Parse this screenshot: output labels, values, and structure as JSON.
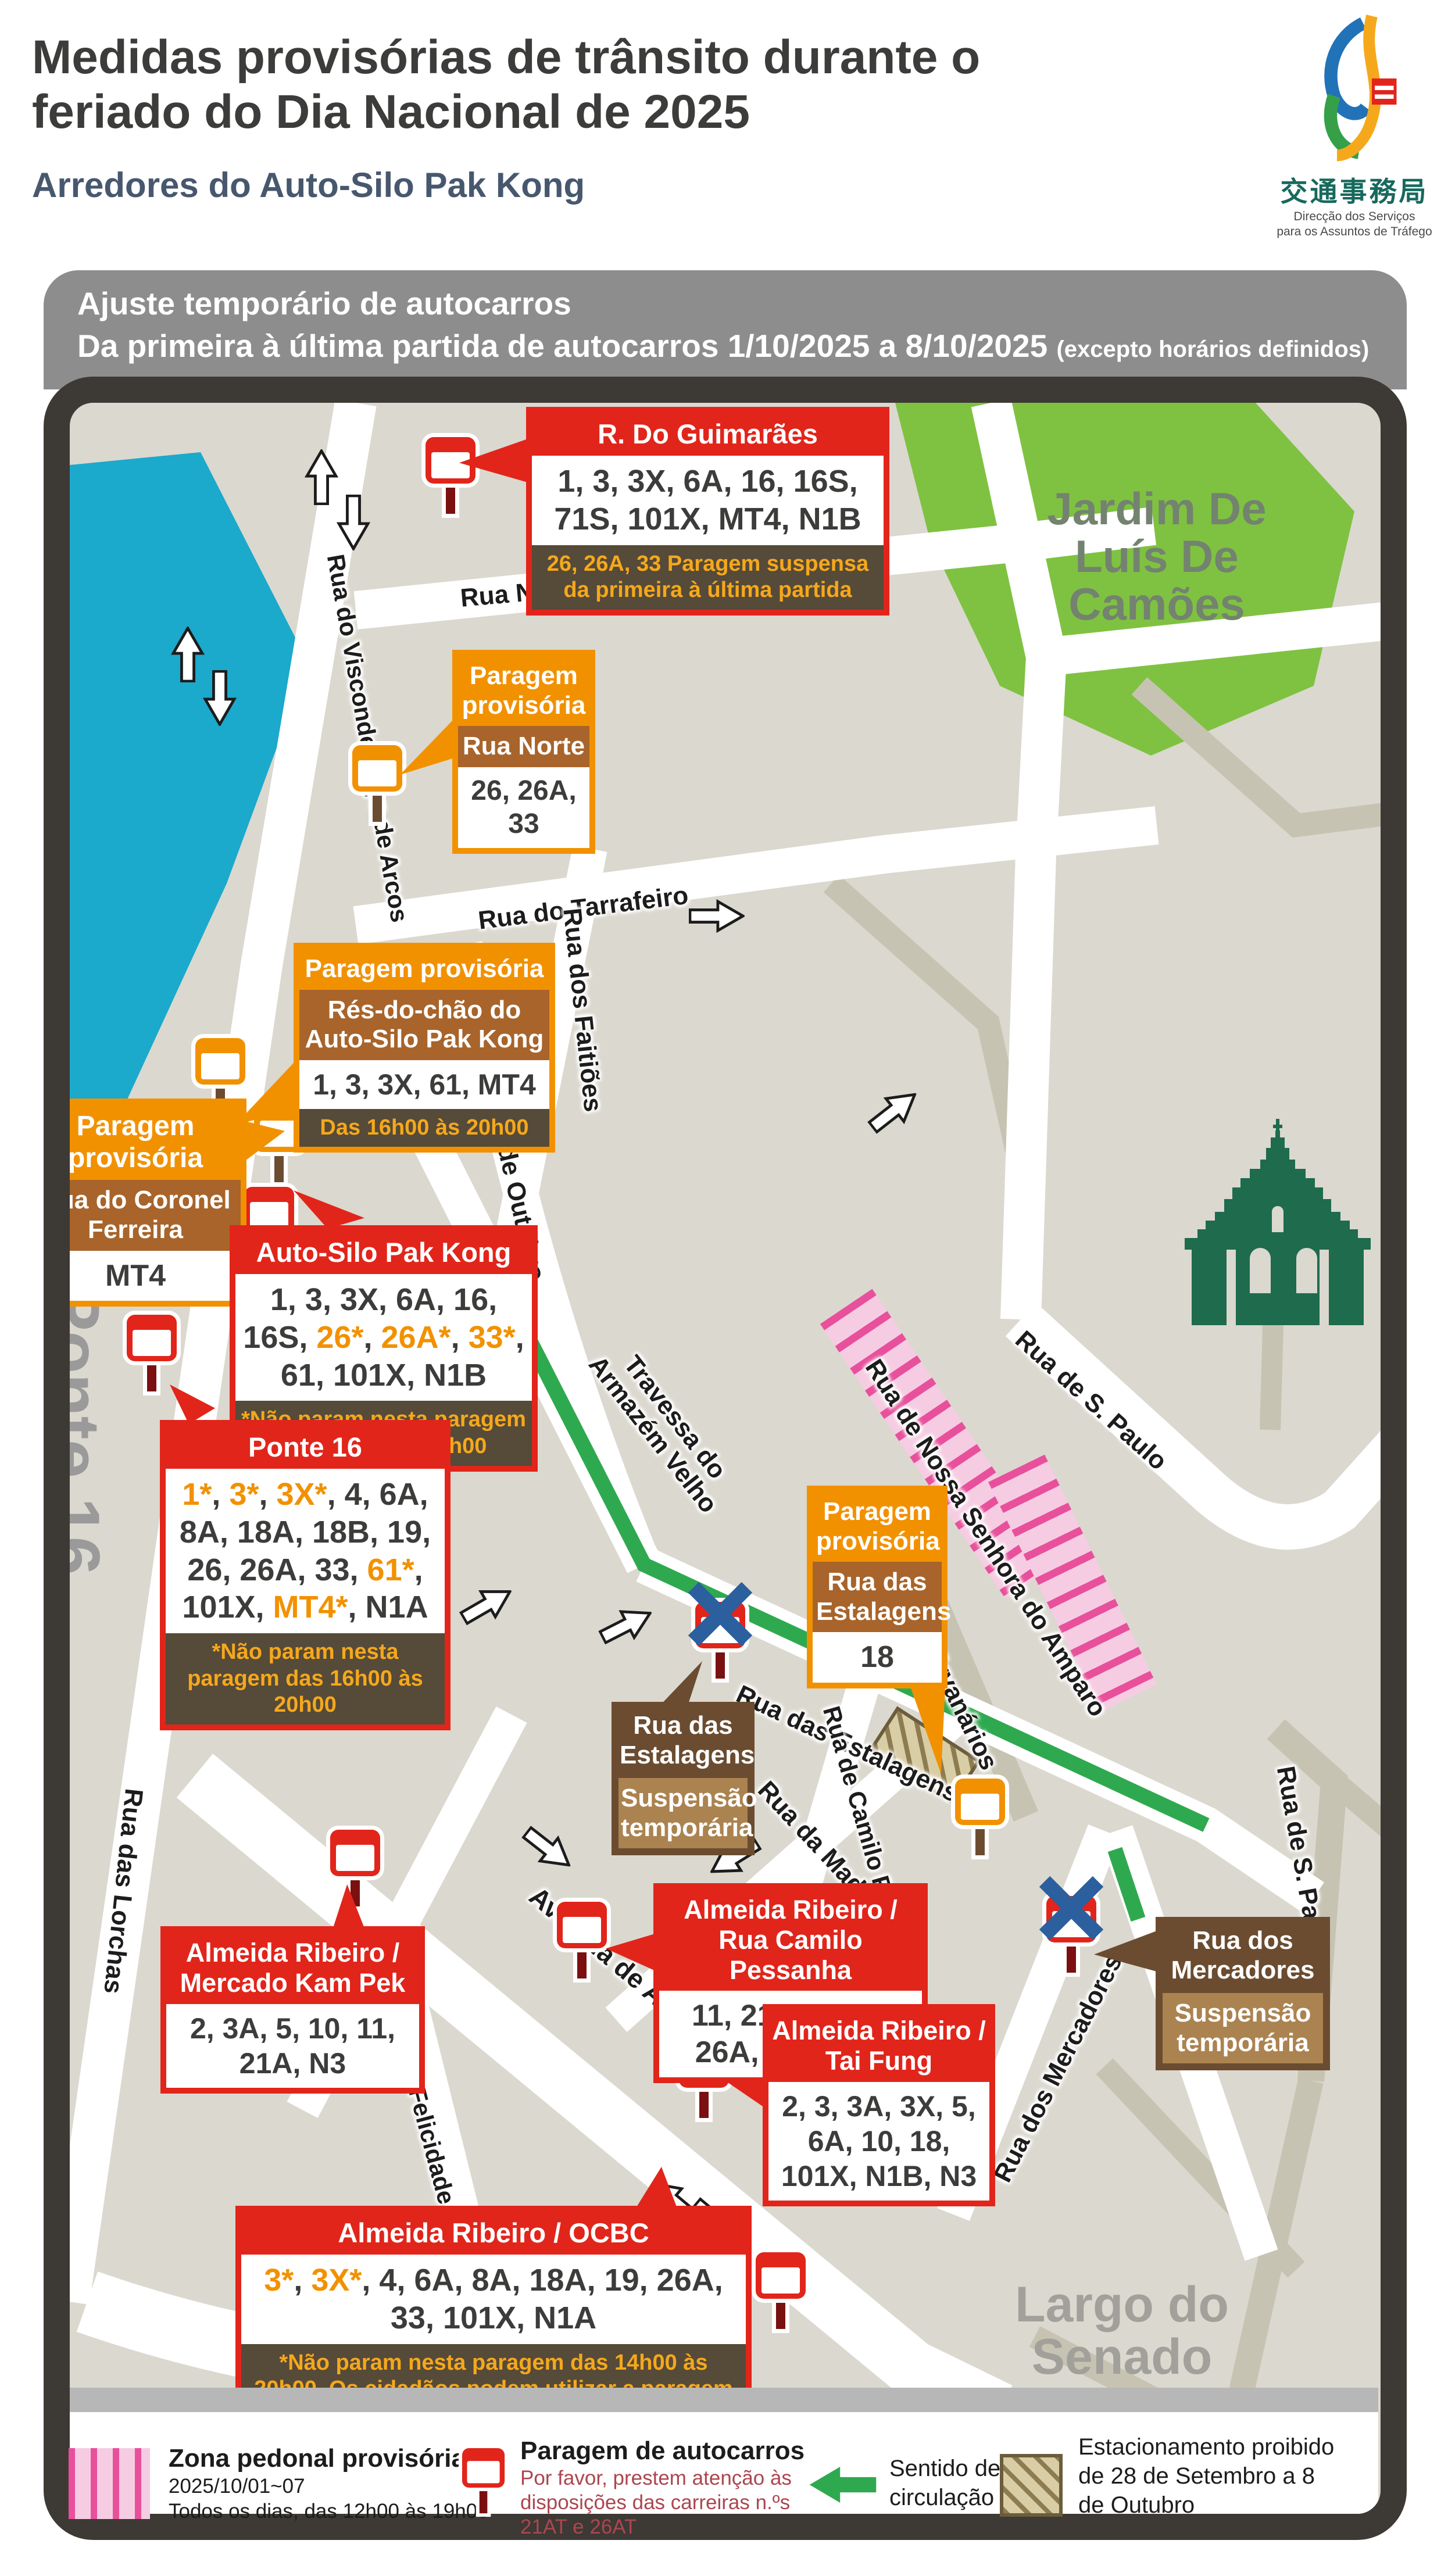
{
  "colors": {
    "orange": "#f29100",
    "blue": "#1b7ac0",
    "dark": "#3c3c3b"
  },
  "header": {
    "title1": "Medidas provisórias de trânsito durante o",
    "title2": "feriado do Dia Nacional de 2025",
    "subtitle": "Arredores do Auto-Silo Pak Kong",
    "logo_cn": "交通事務局",
    "logo_pt1": "Direcção dos Serviços",
    "logo_pt2": "para os Assuntos de Tráfego"
  },
  "banner": {
    "line1": "Ajuste temporário de autocarros",
    "line2": "Da primeira à última partida de autocarros 1/10/2025 a 8/10/2025 ",
    "line2b": "(excepto horários definidos)"
  },
  "areas": {
    "park1": "Jardim De",
    "park2": "Luís De",
    "park3": "Camões",
    "ponte": "Ponte 16",
    "largo1": "Largo do",
    "largo2": "Senado"
  },
  "streets": [
    "Rua Norte",
    "Rua do Tarrafeiro",
    "Rua do Visconde Paço de Arcos",
    "Rua dos Faitiões",
    "Rua de Cinco de Outubro",
    "Travessa do Armazém Velho",
    "Rua das Estalagens",
    "Rua de Nossa Senhora do Amparo",
    "Rua dos Ervanários",
    "Rua de S. Paulo",
    "Rua de S. Paulo",
    "Rua de Camilo Pessanha",
    "Rua da Madeira",
    "Avenida de Almeida Ribeiro",
    "Rua das Lorchas",
    "Rua da Felicidade",
    "Rua dos Mercadores"
  ],
  "callouts": {
    "guimaraes": {
      "title": "R. Do Guimarães",
      "body": "1, 3, 3X, 6A, 16, 16S, 71S, 101X, MT4, N1B",
      "note": "26, 26A, 33 Paragem suspensa da primeira à última partida"
    },
    "norte": {
      "title": "Paragem provisória",
      "sub": "Rua Norte",
      "body": "26, 26A, 33"
    },
    "resdochao": {
      "title": "Paragem provisória",
      "sub": "Rés-do-chão do Auto-Silo Pak Kong",
      "body": "1, 3, 3X, 61, MT4",
      "note": "Das 16h00 às 20h00"
    },
    "coronel": {
      "title": "Paragem provisória",
      "sub": "Rua do Coronel Ferreira",
      "body": "MT4"
    },
    "autosilo": {
      "title": "Auto-Silo Pak Kong",
      "body_segments": [
        {
          "t": "1, 3, 3X, 6A, 16, 16S, "
        },
        {
          "t": "26*",
          "c": "orange"
        },
        {
          "t": ", "
        },
        {
          "t": "26A*",
          "c": "orange"
        },
        {
          "t": ", "
        },
        {
          "t": "33*",
          "c": "orange"
        },
        {
          "t": ", 61, 101X, N1B"
        }
      ],
      "note": "*Não param nesta paragem das 12h00 às 17h00"
    },
    "ponte16": {
      "title": "Ponte 16",
      "body_segments": [
        {
          "t": "1*",
          "c": "orange"
        },
        {
          "t": ", "
        },
        {
          "t": "3*",
          "c": "orange"
        },
        {
          "t": ", "
        },
        {
          "t": "3X*",
          "c": "orange"
        },
        {
          "t": ", 4, 6A, 8A, 18A, 18B, 19, 26, 26A, 33, "
        },
        {
          "t": "61*",
          "c": "orange"
        },
        {
          "t": ", 101X, "
        },
        {
          "t": "MT4*",
          "c": "orange"
        },
        {
          "t": ", N1A"
        }
      ],
      "note": "*Não param nesta paragem das 16h00 às 20h00"
    },
    "estalagens18": {
      "title": "Paragem provisória",
      "sub": "Rua das Estalagens",
      "body": "18"
    },
    "estalagens_susp": {
      "title": "Rua das Estalagens",
      "body": "Suspensão temporária"
    },
    "camilo": {
      "title": "Almeida Ribeiro / Rua Camilo Pessanha",
      "body_segments": [
        {
          "t": "11, 21A, "
        },
        {
          "t": "21AT",
          "c": "blue"
        },
        {
          "t": ", 26A, "
        },
        {
          "t": "26AT",
          "c": "blue"
        },
        {
          "t": ", 33"
        }
      ]
    },
    "kampek": {
      "title": "Almeida Ribeiro / Mercado Kam Pek",
      "body": "2, 3A, 5, 10, 11, 21A, N3"
    },
    "taifung": {
      "title": "Almeida Ribeiro / Tai Fung",
      "body": "2, 3, 3A, 3X, 5, 6A, 10, 18, 101X, N1B, N3"
    },
    "mercadores": {
      "title": "Rua dos Mercadores",
      "body": "Suspensão temporária"
    },
    "ocbc": {
      "title": "Almeida Ribeiro / OCBC",
      "body_segments": [
        {
          "t": "3*",
          "c": "orange"
        },
        {
          "t": ", "
        },
        {
          "t": "3X*",
          "c": "orange"
        },
        {
          "t": ", 4, 6A, 8A, 18A, 19, 26A, 33, 101X, N1A"
        }
      ],
      "note": "*Não param nesta paragem das 14h00 às 20h00. Os cidadãos podem utilizar a paragem provisória na Rua do Dr. Pedro José Lobo."
    }
  },
  "legend": {
    "zona": {
      "title": "Zona pedonal provisória",
      "line1": "2025/10/01~07",
      "line2": "Todos os dias, das 12h00 às 19h00"
    },
    "paragem": {
      "title": "Paragem de autocarros",
      "note1": "Por favor, prestem atenção às",
      "note2": "disposições das carreiras n.ºs",
      "note3": "21AT e 26AT"
    },
    "sentido": {
      "line1": "Sentido de",
      "line2": "circulação"
    },
    "estacionamento": {
      "line1": "Estacionamento proibido",
      "line2": "de 28 de Setembro a 8",
      "line3": "de Outubro"
    }
  }
}
